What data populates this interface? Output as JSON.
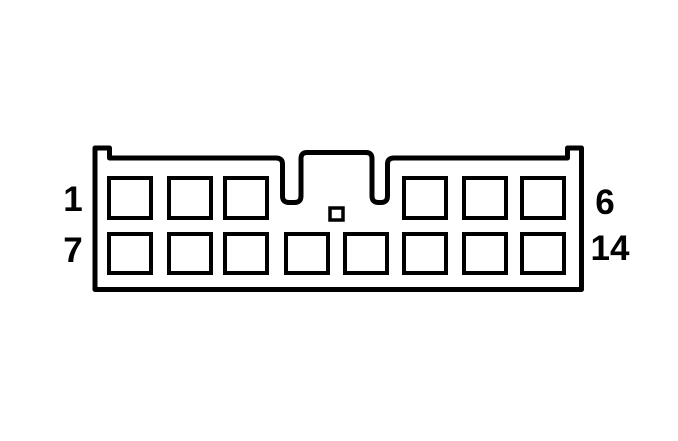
{
  "connector": {
    "type": "connector-pinout-diagram",
    "rows": {
      "top": {
        "pin_count": 6,
        "first_pin_label": "1",
        "last_pin_label": "6"
      },
      "bottom": {
        "pin_count": 8,
        "first_pin_label": "7",
        "last_pin_label": "14"
      }
    },
    "labels": {
      "pin1": "1",
      "pin6": "6",
      "pin7": "7",
      "pin14": "14"
    },
    "colors": {
      "line": "#000000",
      "background": "#ffffff"
    }
  }
}
